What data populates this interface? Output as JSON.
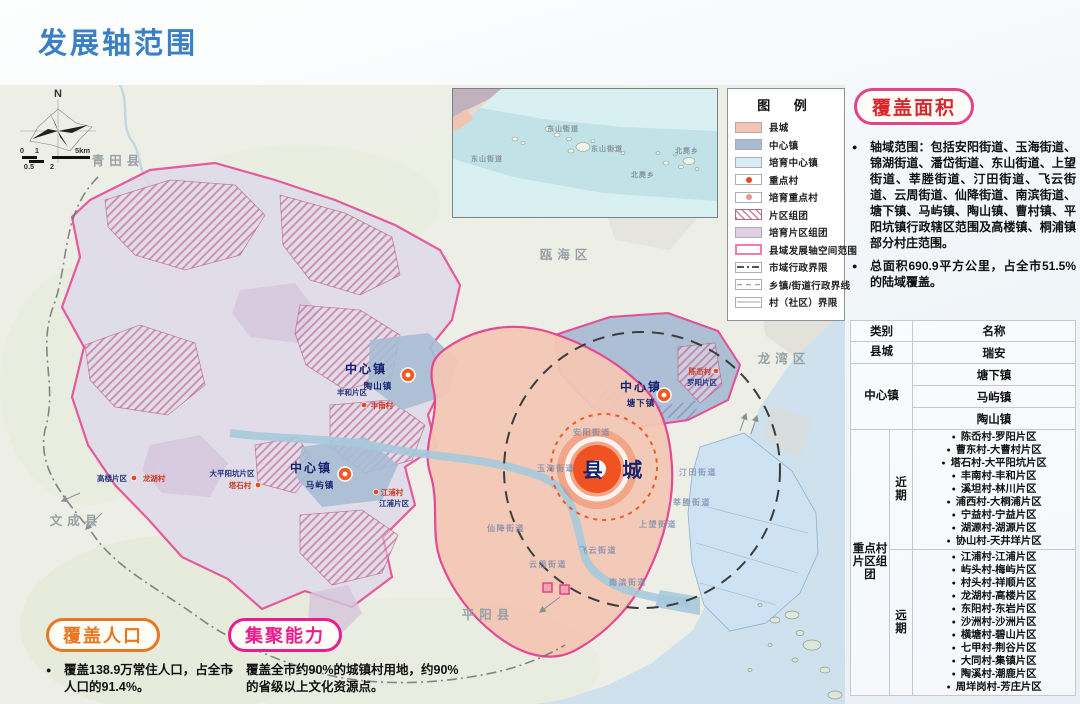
{
  "title": "发展轴范围",
  "colors": {
    "accent_blue": "#3b7fc4",
    "axis_boundary_magenta": "#e6418f",
    "county_city_fill": "#f2c3b1",
    "center_town_fill": "#a7bcd4",
    "orange": "#e87722",
    "red": "#d9262c"
  },
  "legend": {
    "title": "图 例",
    "items": [
      {
        "label": "县城",
        "type": "fill",
        "color": "#f2c3b1"
      },
      {
        "label": "中心镇",
        "type": "fill",
        "color": "#a7bcd4"
      },
      {
        "label": "培育中心镇",
        "type": "fill",
        "color": "#d8ecf8"
      },
      {
        "label": "重点村",
        "type": "dot",
        "color": "#e8481f"
      },
      {
        "label": "培育重点村",
        "type": "dot",
        "color": "#e09a8e"
      },
      {
        "label": "片区组团",
        "type": "hatch"
      },
      {
        "label": "培育片区组团",
        "type": "fill",
        "color": "#e0d0e4"
      },
      {
        "label": "县域发展轴空间范围",
        "type": "outline"
      },
      {
        "label": "市域行政界限",
        "type": "dashdot"
      },
      {
        "label": "乡镇/街道行政界线",
        "type": "dashed"
      },
      {
        "label": "村（社区）界限",
        "type": "thin"
      }
    ]
  },
  "coverage_area": {
    "badge": "覆盖面积",
    "bullets": [
      "轴域范围：包括安阳街道、玉海街道、锦湖街道、潘岱街道、东山街道、上望街道、莘塍街道、汀田街道、飞云街道、云周街道、仙降街道、南滨街道、塘下镇、马屿镇、陶山镇、曹村镇、平阳坑镇行政辖区范围及高楼镇、桐浦镇部分村庄范围。",
      "总面积690.9平方公里，占全市51.5%的陆域覆盖。"
    ]
  },
  "table": {
    "headers": [
      "类别",
      "名称"
    ],
    "county_city": {
      "category": "县城",
      "name": "瑞安"
    },
    "center_towns": {
      "category": "中心镇",
      "names": [
        "塘下镇",
        "马屿镇",
        "陶山镇"
      ]
    },
    "key_village_clusters": {
      "category": "重点村片区组团",
      "phases": [
        {
          "label": "近期",
          "items": [
            "陈岙村-罗阳片区",
            "曹东村-大曹村片区",
            "塔石村-大平阳坑片区",
            "丰南村-丰和片区",
            "溪坦村-林川片区",
            "浦西村-大桐浦片区",
            "宁益村-宁益片区",
            "湖源村-湖源片区",
            "协山村-天井垟片区"
          ]
        },
        {
          "label": "远期",
          "items": [
            "江浦村-江浦片区",
            "屿头村-梅屿片区",
            "村头村-祥顺片区",
            "龙湖村-高楼片区",
            "东阳村-东岩片区",
            "沙洲村-沙洲片区",
            "横塘村-碧山片区",
            "七甲村-荆谷片区",
            "大同村-集镇片区",
            "陶溪村-潮鹿片区",
            "周垟岗村-芳庄片区"
          ]
        }
      ]
    }
  },
  "coverage_population": {
    "badge": "覆盖人口",
    "bullet": "覆盖138.9万常住人口，占全市人口的91.4%。"
  },
  "agglomeration": {
    "badge": "集聚能力",
    "bullet": "覆盖全市约90%的城镇村用地，约90%的省级以上文化资源点。"
  },
  "map": {
    "compass_label": "N",
    "scale_labels": [
      "0",
      "1",
      "5km",
      "0.5",
      "2"
    ],
    "regions": [
      {
        "t": "青田县",
        "x": 118,
        "y": 80
      },
      {
        "t": "瓯海区",
        "x": 566,
        "y": 174
      },
      {
        "t": "龙湾区",
        "x": 784,
        "y": 278
      },
      {
        "t": "文成县",
        "x": 76,
        "y": 440
      },
      {
        "t": "平阳县",
        "x": 488,
        "y": 534
      }
    ],
    "streets": [
      {
        "t": "安阳街道",
        "x": 592,
        "y": 350
      },
      {
        "t": "玉海街道",
        "x": 556,
        "y": 386
      },
      {
        "t": "汀田街道",
        "x": 698,
        "y": 390
      },
      {
        "t": "莘塍街道",
        "x": 692,
        "y": 420
      },
      {
        "t": "上望街道",
        "x": 658,
        "y": 442
      },
      {
        "t": "飞云街道",
        "x": 598,
        "y": 468
      },
      {
        "t": "云周街道",
        "x": 548,
        "y": 482
      },
      {
        "t": "仙降街道",
        "x": 506,
        "y": 446
      },
      {
        "t": "南滨街道",
        "x": 628,
        "y": 500
      }
    ],
    "center_towns": [
      {
        "label": "中心镇",
        "name": "陶山镇",
        "lx": 366,
        "ly": 288,
        "nx": 378,
        "ny": 304,
        "dx": 408,
        "dy": 290
      },
      {
        "label": "中心镇",
        "name": "马屿镇",
        "lx": 311,
        "ly": 387,
        "nx": 320,
        "ny": 403,
        "dx": 345,
        "dy": 389
      },
      {
        "label": "中心镇",
        "name": "塘下镇",
        "lx": 641,
        "ly": 306,
        "nx": 641,
        "ny": 321,
        "dx": 664,
        "dy": 310
      }
    ],
    "county_city": {
      "label": "县 城",
      "x": 616,
      "y": 392
    },
    "key_villages": [
      {
        "village": "陈岙村",
        "area": "罗阳片区",
        "vx": 700,
        "vy": 289,
        "ax": 702,
        "ay": 300,
        "dx": 716,
        "dy": 286
      },
      {
        "village": "龙湖村",
        "area": "高楼片区",
        "vx": 154,
        "vy": 396,
        "ax": 112,
        "ay": 396,
        "dx": 134,
        "dy": 393
      },
      {
        "village": "塔石村",
        "area": "大平阳坑片区",
        "vx": 240,
        "vy": 403,
        "ax": 232,
        "ay": 391,
        "dx": 258,
        "dy": 400
      },
      {
        "village": "丰南村",
        "area": "丰和片区",
        "vx": 382,
        "vy": 323,
        "ax": 352,
        "ay": 310,
        "dx": 364,
        "dy": 320
      },
      {
        "village": "江浦村",
        "area": "江浦片区",
        "vx": 392,
        "vy": 410,
        "ax": 394,
        "ay": 421,
        "dx": 376,
        "dy": 407
      }
    ],
    "inset_labels": [
      {
        "t": "东山街道",
        "x": 34,
        "y": 72
      },
      {
        "t": "东山街道",
        "x": 110,
        "y": 42
      },
      {
        "t": "东山街道",
        "x": 154,
        "y": 62
      },
      {
        "t": "北麂乡",
        "x": 234,
        "y": 64
      },
      {
        "t": "北麂乡",
        "x": 190,
        "y": 88
      }
    ]
  }
}
